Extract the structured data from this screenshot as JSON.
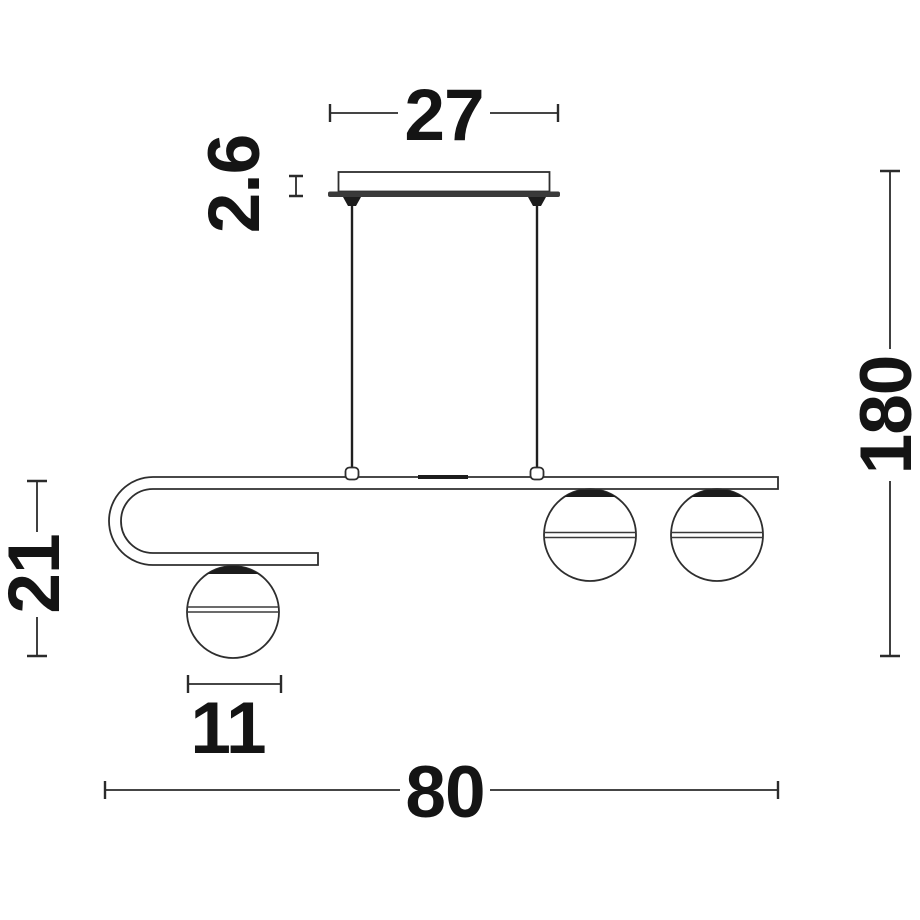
{
  "title": "Pendant lamp technical dimension drawing",
  "colors": {
    "background": "#ffffff",
    "line": "#2e2e2e",
    "ink": "#141414",
    "dark_fill": "#1c1c1c"
  },
  "dimensions": {
    "canopy_width": "27",
    "canopy_thickness": "2.6",
    "left_drop_height": "21",
    "overall_height": "180",
    "globe_diameter": "11",
    "overall_width": "80"
  }
}
